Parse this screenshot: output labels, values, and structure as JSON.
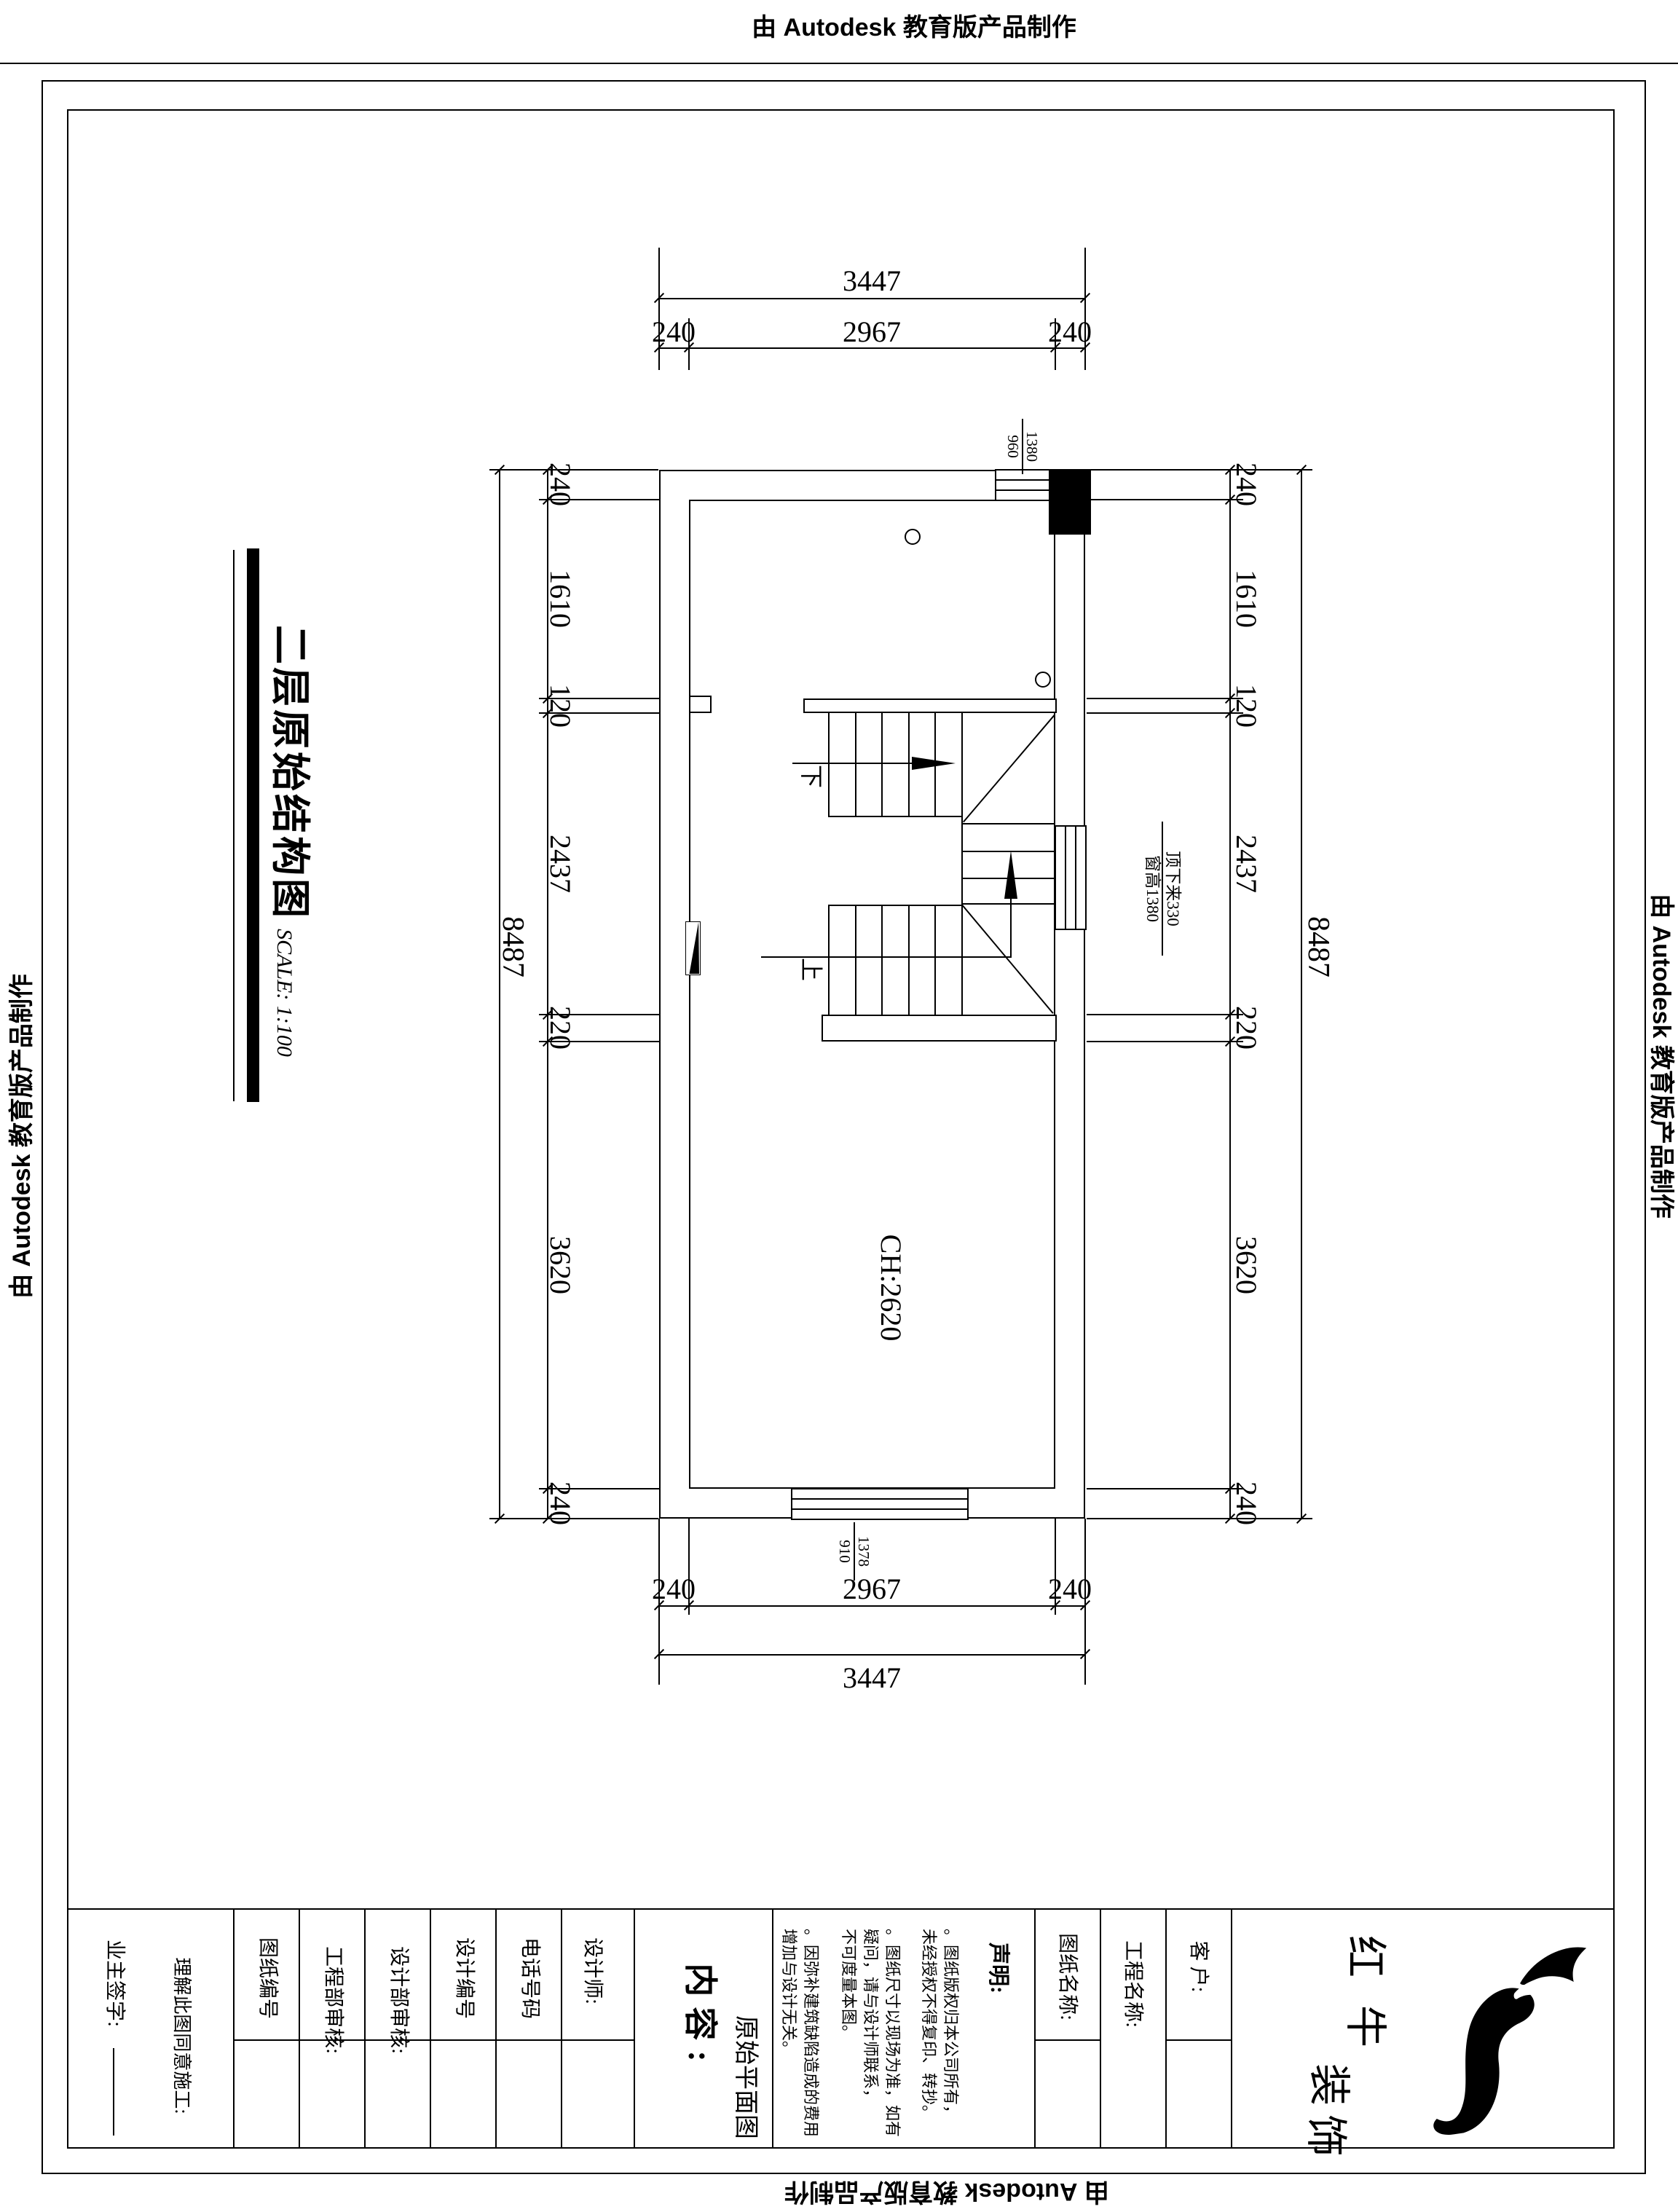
{
  "watermark": {
    "text": "由 Autodesk 教育版产品制作"
  },
  "sheet_title": {
    "text": "二层原始结构图",
    "scale": "SCALE: 1:100"
  },
  "plan": {
    "room_label": "CH:2620",
    "stair_down": "下",
    "stair_up": "上",
    "labels": {
      "top_window": {
        "line1": "1380",
        "line2": "960"
      },
      "right_window": {
        "line1": "顶下来330",
        "line2": "窗高1380"
      },
      "bottom_window": {
        "line1": "1378",
        "line2": "910"
      }
    }
  },
  "dims": {
    "top": {
      "overall": "3447",
      "parts": [
        "240",
        "2967",
        "240"
      ]
    },
    "bottom": {
      "overall": "3447",
      "parts": [
        "240",
        "2967",
        "240"
      ]
    },
    "left": {
      "overall": "8487",
      "parts": [
        "240",
        "1610",
        "120",
        "2437",
        "220",
        "3620",
        "240"
      ]
    },
    "right": {
      "overall": "8487",
      "parts": [
        "240",
        "1610",
        "120",
        "2437",
        "220",
        "3620",
        "240"
      ]
    }
  },
  "titleblock": {
    "owner_sign": "业主签字:",
    "agree": "理解此图同意施工:",
    "fields": [
      "图纸编号",
      "工程部审核:",
      "设计部审核:",
      "设计编号",
      "电话号码",
      "设计师:"
    ],
    "content_label": "内容:",
    "content_value": "原始平面图",
    "notes_title": "声明:",
    "notes": {
      "n1l1": "。图纸版权归本公司所有，",
      "n1l2": "未经授权不得复印、转抄。",
      "n2l1": "。图纸尺寸以现场为准，如有",
      "n2l2": "疑问，请与设计师联系，",
      "n2l3": "不可度量本图。",
      "n3l1": "。因弥补建筑缺陷造成的费用",
      "n3l2": "增加与设计无关。"
    },
    "drawing_name": "图纸名称:",
    "project_name": "工程名称:",
    "client": "客 户:",
    "brand": {
      "c1": "红",
      "c2": "牛",
      "c3": "装",
      "c4": "饰"
    }
  }
}
